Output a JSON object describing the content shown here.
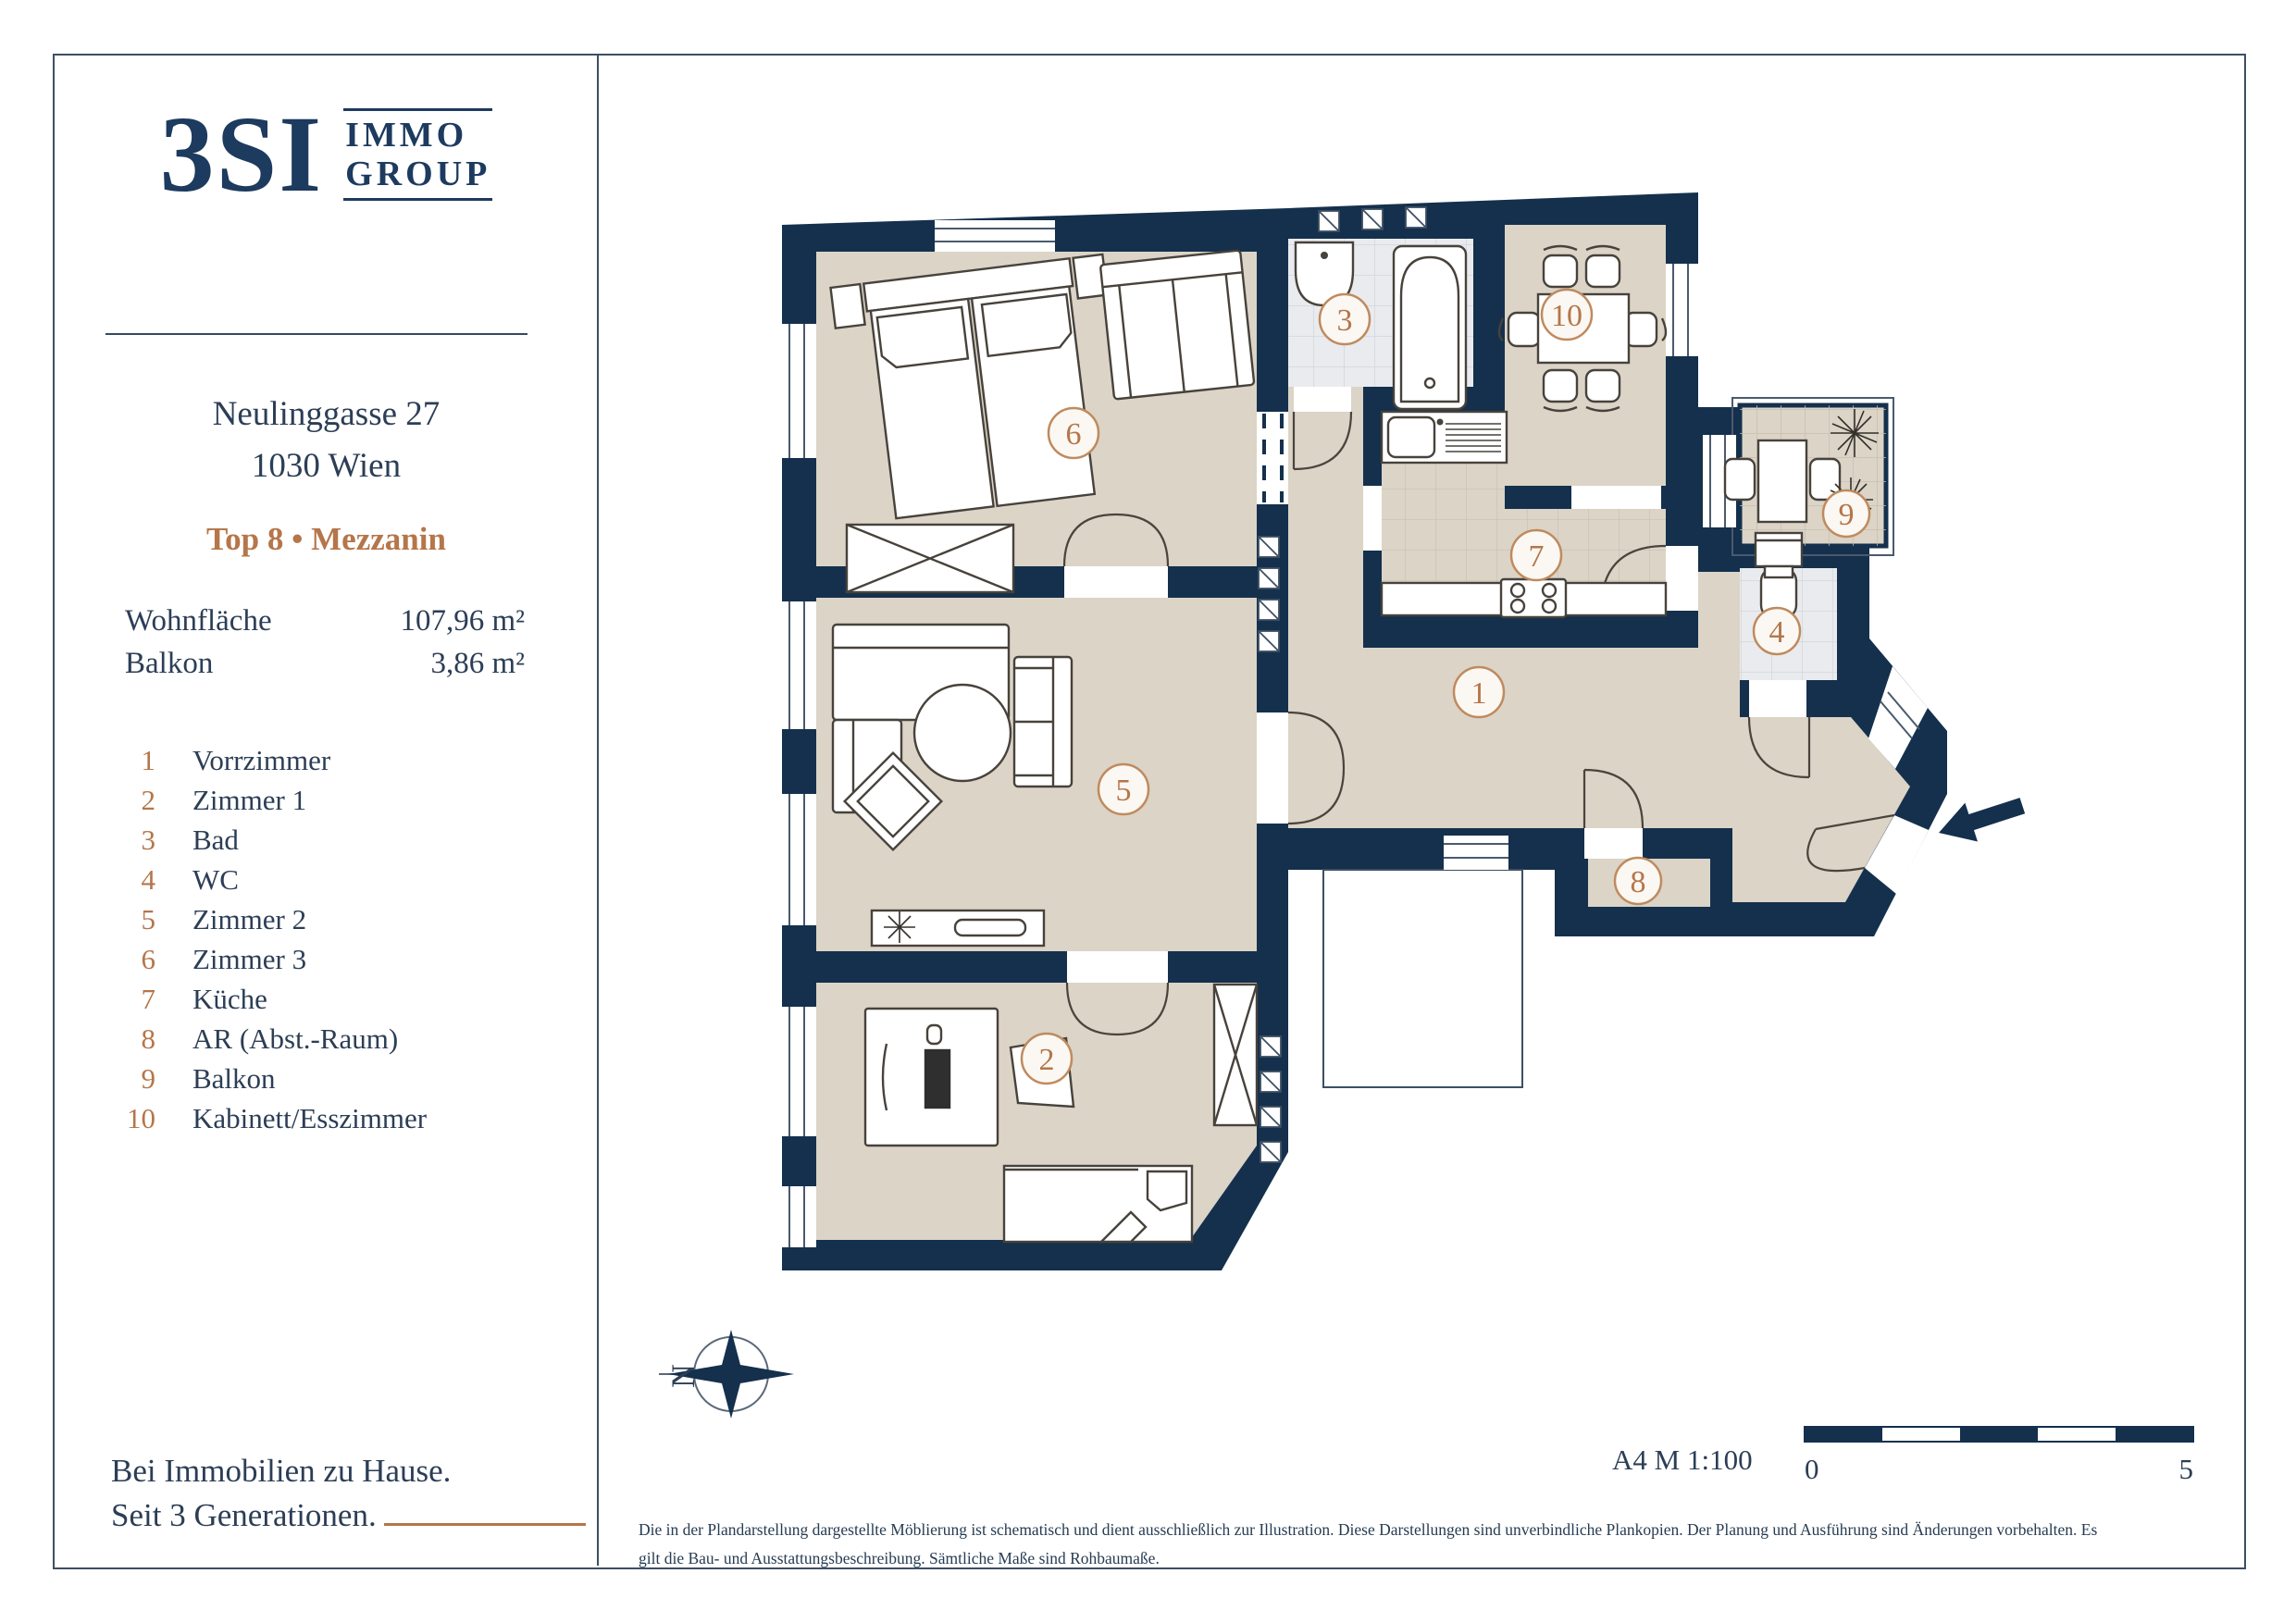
{
  "brand": {
    "logo_main": "3SI",
    "logo_sub1": "IMMO",
    "logo_sub2": "GROUP",
    "tagline1": "Bei Immobilien zu Hause.",
    "tagline2": "Seit 3 Generationen."
  },
  "property": {
    "address_line1": "Neulinggasse 27",
    "address_line2": "1030 Wien",
    "unit": "Top 8 • Mezzanin",
    "areas": [
      {
        "label": "Wohnfläche",
        "value": "107,96 m²"
      },
      {
        "label": "Balkon",
        "value": "3,86 m²"
      }
    ]
  },
  "legend": {
    "items": [
      {
        "num": "1",
        "label": "Vorrzimmer"
      },
      {
        "num": "2",
        "label": "Zimmer 1"
      },
      {
        "num": "3",
        "label": "Bad"
      },
      {
        "num": "4",
        "label": "WC"
      },
      {
        "num": "5",
        "label": "Zimmer 2"
      },
      {
        "num": "6",
        "label": "Zimmer  3"
      },
      {
        "num": "7",
        "label": "Küche"
      },
      {
        "num": "8",
        "label": "AR (Abst.-Raum)"
      },
      {
        "num": "9",
        "label": "Balkon"
      },
      {
        "num": "10",
        "label": "Kabinett/Esszimmer"
      }
    ]
  },
  "plan": {
    "badges": [
      {
        "n": "1"
      },
      {
        "n": "2"
      },
      {
        "n": "3"
      },
      {
        "n": "4"
      },
      {
        "n": "5"
      },
      {
        "n": "6"
      },
      {
        "n": "7"
      },
      {
        "n": "8"
      },
      {
        "n": "9"
      },
      {
        "n": "10"
      }
    ],
    "compass_label": "N",
    "scale_note": "A4  M 1:100",
    "scale_start": "0",
    "scale_end": "5"
  },
  "footnote": {
    "line1": "Die in der Plandarstellung dargestellte Möblierung ist schematisch und dient ausschließlich zur Illustration. Diese Darstellungen sind unverbindliche Plankopien. Der Planung und Ausführung sind Änderungen vorbehalten. Es",
    "line2": "gilt die Bau- und Ausstattungsbeschreibung. Sämtliche Maße sind Rohbaumaße."
  },
  "colors": {
    "navy": "#14304d",
    "accent": "#b5764a",
    "floor_beige": "#dbd4c7",
    "tile_gray": "#e9ebee"
  }
}
